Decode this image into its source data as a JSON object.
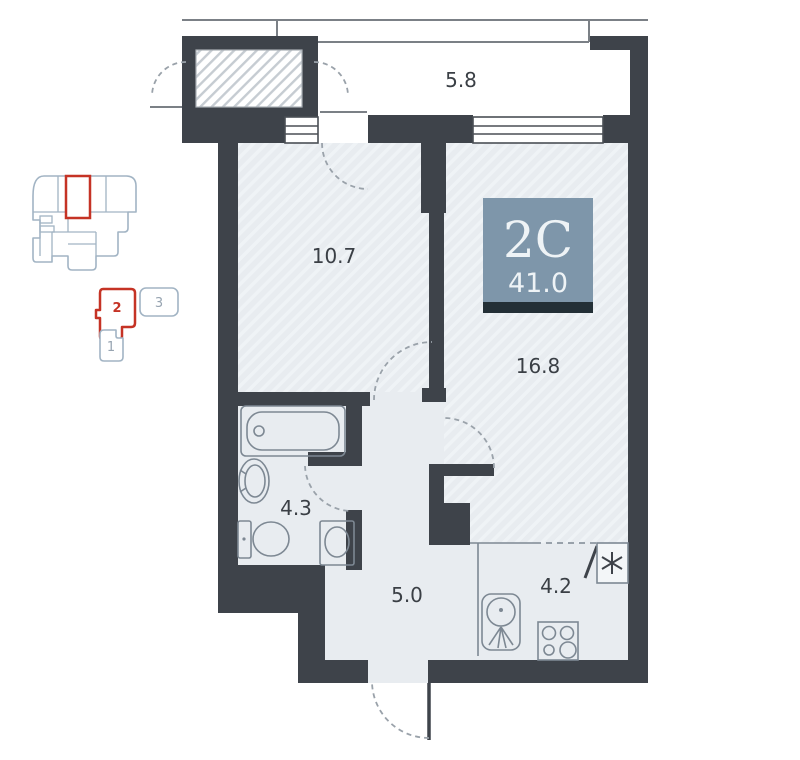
{
  "unit_card": {
    "type_label": "2С",
    "area_value": "41.0"
  },
  "plan_labels": {
    "balcony": "5.8",
    "room": "10.7",
    "living": "16.8",
    "bathroom": "4.3",
    "hall": "5.0",
    "kitchen": "4.2"
  },
  "section_selector": {
    "active_section": "2",
    "items": [
      {
        "label": "2",
        "active": true
      },
      {
        "label": "3",
        "active": false
      },
      {
        "label": "1",
        "active": false
      }
    ]
  },
  "icons": {
    "fridge": "asterisk-snowflake",
    "fixtures": [
      "bathtub",
      "pedestal-sink",
      "toilet",
      "washing-machine",
      "kitchen-sink",
      "stove-4-burner"
    ]
  },
  "colors": {
    "wall": "#3e434a",
    "floor": "#e8ecf0",
    "hatch_stripe": "#eff3f6",
    "badge_bg": "#7e96aa",
    "badge_strip": "#232f36",
    "badge_text": "#eef3f6",
    "accent_red": "#c53325",
    "minimap_stroke": "#a2b4c4",
    "label_text": "#3a3f45",
    "fixture_stroke": "#7d8893"
  }
}
